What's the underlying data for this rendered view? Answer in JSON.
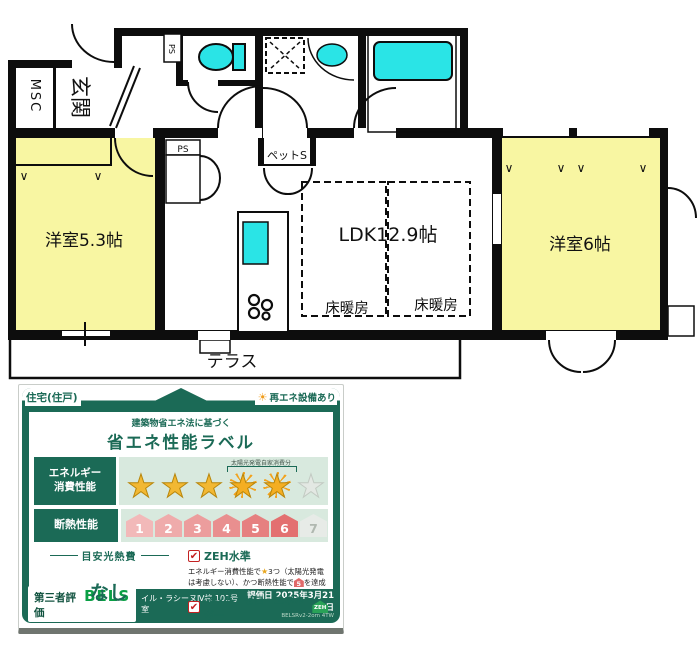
{
  "floorplan": {
    "entrance": "玄関",
    "msc": "MSC",
    "ps_top": "PS",
    "ps_mid": "PS",
    "pet_storage": "ペットS",
    "room_left": "洋室5.3帖",
    "ldk": "LDK12.9帖",
    "floor_heating_1": "床暖房",
    "floor_heating_2": "床暖房",
    "room_right": "洋室6帖",
    "terrace": "テラス",
    "colors": {
      "room_fill": "#f8f6a2",
      "fixture": "#2ae4e6",
      "wall": "#0d0d0d"
    }
  },
  "energy_label": {
    "dwelling_tab": "住宅(住戸)",
    "renewable_note": "再エネ設備あり",
    "law_line": "建築物省エネ法に基づく",
    "title": "省エネ性能ラベル",
    "energy_row": {
      "label_line1": "エネルギー",
      "label_line2": "消費性能",
      "stars_filled": 3,
      "stars_solar": 2,
      "stars_empty": 1,
      "solar_bracket_note": "太陽光発電自家消費分"
    },
    "insulation_row": {
      "label": "断熱性能",
      "levels": [
        "1",
        "2",
        "3",
        "4",
        "5",
        "6",
        "7"
      ],
      "achieved_level": 6
    },
    "cost": {
      "heading": "目安光熱費",
      "value": "なし"
    },
    "zeh": {
      "title": "ZEH水準",
      "desc_before_star": "エネルギー消費性能で",
      "desc_mid": "3つ（太陽光発電は考慮しない）、かつ断熱性能で",
      "badge": "5",
      "desc_after_badge": "を達成"
    },
    "nze": {
      "title": "ネット・ゼロ・エネルギー",
      "zeh_icon_text": "ZEH",
      "desc": "太陽光発電の売電分も含めてエネルギー収支がゼロ以下を達成"
    },
    "footer": {
      "third_party": "第三者評価",
      "bels": "BELS",
      "building": "イル・ラシーヌⅣ棟 101号室",
      "eval_date": "評価日 2025年3月21日",
      "cert_note": "BELSRv2-2om 4TW"
    }
  },
  "icons": {
    "star": "★",
    "sun": "☀",
    "check": "✔",
    "v_mark": "∨"
  }
}
